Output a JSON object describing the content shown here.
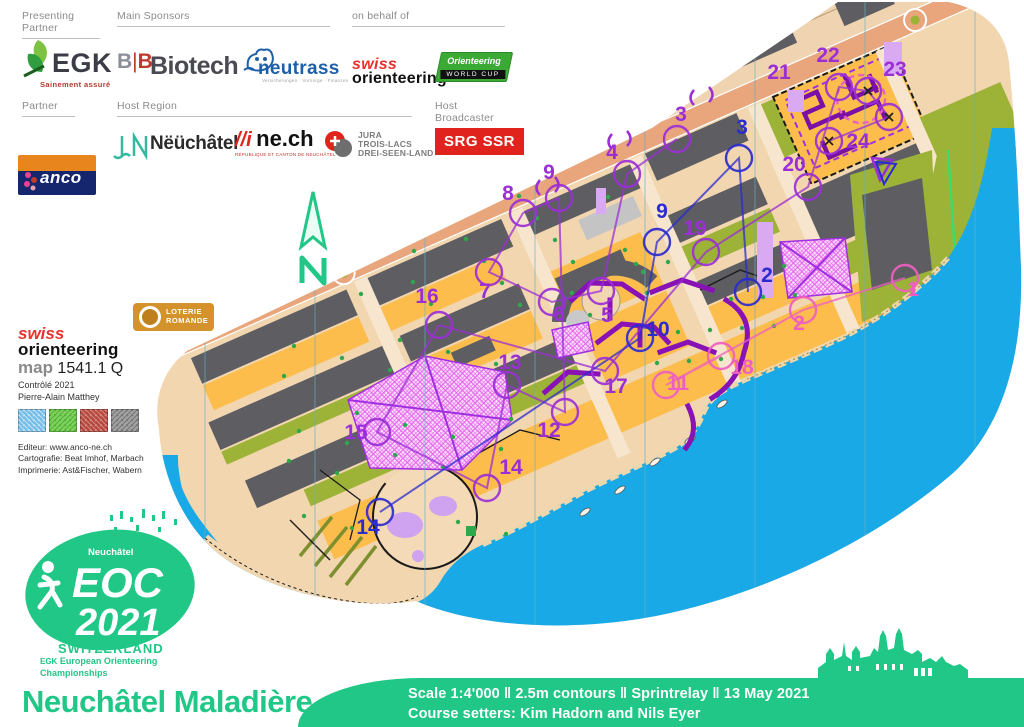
{
  "header": {
    "presenting_partner_label": "Presenting Partner",
    "main_sponsors_label": "Main Sponsors",
    "on_behalf_label": "on behalf of",
    "partner_label": "Partner",
    "host_region_label": "Host Region",
    "host_broadcaster_label": "Host Broadcaster",
    "egk": {
      "name": "EGK",
      "tagline": "Sainement assuré"
    },
    "bb_biotech": {
      "b1": "B",
      "bar": "|",
      "b2": "B",
      "word": "Biotech"
    },
    "neutrass": {
      "name": "neutrass",
      "tagline": "Versicherungen · Vorsorge · Finanzen"
    },
    "swiss_orienteering": {
      "line1": "swiss",
      "line2": "orienteering"
    },
    "world_cup": {
      "line1": "Orienteering",
      "line2": "WORLD CUP"
    },
    "banco": {
      "name": "anco"
    },
    "ville_neuchatel": {
      "name": "Nëüchâtel"
    },
    "ne_ch": {
      "name": "ne.ch",
      "sub": "RÉPUBLIQUE ET CANTON DE NEUCHÂTEL"
    },
    "jura": {
      "l1": "JURA",
      "l2": "TROIS-LACS",
      "l3": "DREI-SEEN-LAND"
    },
    "srg": {
      "name": "SRG SSR"
    }
  },
  "map_info": {
    "brand1": "swiss",
    "brand2": "orienteering",
    "map_word": "map",
    "map_number": "1541.1 Q",
    "control_line": "Contrôlé 2021",
    "controller": "Pierre-Alain Matthey",
    "editor": "Editeur: www.anco-ne.ch",
    "cartography": "Cartografie: Beat Imhof, Marbach",
    "printer": "Imprimerie: Ast&Fischer, Wabern",
    "loterie_l1": "LOTERIE",
    "loterie_l2": "ROMANDE"
  },
  "compass": {
    "letter": "N"
  },
  "eoc_logo": {
    "city": "Neuchâtel",
    "line1": "EOC",
    "line2": "2021",
    "line3": "SWITZERLAND",
    "egk": "EGK",
    "line4": "European Orienteering",
    "line5": "Championships"
  },
  "footer": {
    "title": "Neuchâtel Maladière",
    "bar_line1": "Scale 1:4'000  ‖  2.5m contours  ‖  Sprintrelay  ‖  13 May 2021",
    "bar_line2": "Course setters: Kim Hadorn and Nils Eyer"
  },
  "course": {
    "colors": {
      "violet": "#9b2fd6",
      "blue": "#2b2bcf",
      "pink": "#ef5fc0"
    },
    "controls": [
      {
        "n": 3,
        "color": "violet",
        "cx": 677,
        "cy": 139,
        "tx": 681,
        "ty": 121
      },
      {
        "n": 4,
        "color": "violet",
        "cx": 627,
        "cy": 174,
        "tx": 612,
        "ty": 159
      },
      {
        "n": 5,
        "color": "violet",
        "cx": 601,
        "cy": 291,
        "tx": 607,
        "ty": 322
      },
      {
        "n": 6,
        "color": "violet",
        "cx": 552,
        "cy": 302,
        "tx": 559,
        "ty": 321
      },
      {
        "n": 7,
        "color": "violet",
        "cx": 489,
        "cy": 272,
        "tx": 485,
        "ty": 298
      },
      {
        "n": 8,
        "color": "violet",
        "cx": 523,
        "cy": 213,
        "tx": 508,
        "ty": 200
      },
      {
        "n": 9,
        "color": "violet",
        "cx": 559,
        "cy": 198,
        "tx": 549,
        "ty": 179
      },
      {
        "n": 12,
        "color": "violet",
        "cx": 565,
        "cy": 412,
        "tx": 549,
        "ty": 437
      },
      {
        "n": 13,
        "color": "violet",
        "cx": 507,
        "cy": 385,
        "tx": 510,
        "ty": 369
      },
      {
        "n": 14,
        "color": "violet",
        "cx": 487,
        "cy": 488,
        "tx": 511,
        "ty": 474
      },
      {
        "n": 15,
        "color": "violet",
        "cx": 377,
        "cy": 432,
        "tx": 356,
        "ty": 439
      },
      {
        "n": 16,
        "color": "violet",
        "cx": 439,
        "cy": 325,
        "tx": 427,
        "ty": 303
      },
      {
        "n": 17,
        "color": "violet",
        "cx": 605,
        "cy": 371,
        "tx": 616,
        "ty": 393
      },
      {
        "n": 19,
        "color": "violet",
        "cx": 706,
        "cy": 252,
        "tx": 695,
        "ty": 235
      },
      {
        "n": 20,
        "color": "violet",
        "cx": 808,
        "cy": 187,
        "tx": 794,
        "ty": 171
      },
      {
        "n": 21,
        "color": "violet",
        "cx": 839,
        "cy": 87,
        "tx": 779,
        "ty": 79
      },
      {
        "n": 22,
        "color": "violet",
        "cx": 868,
        "cy": 91,
        "tx": 828,
        "ty": 62,
        "xmark": true
      },
      {
        "n": 23,
        "color": "violet",
        "cx": 889,
        "cy": 117,
        "tx": 895,
        "ty": 76,
        "xmark": true
      },
      {
        "n": 24,
        "color": "violet",
        "cx": 829,
        "cy": 141,
        "tx": 858,
        "ty": 148,
        "xmark": true
      },
      {
        "n": 2,
        "color": "blue",
        "cx": 748,
        "cy": 292,
        "tx": 767,
        "ty": 282
      },
      {
        "n": 3,
        "color": "blue",
        "cx": 739,
        "cy": 158,
        "tx": 742,
        "ty": 134
      },
      {
        "n": 9,
        "color": "blue",
        "cx": 657,
        "cy": 242,
        "tx": 662,
        "ty": 218
      },
      {
        "n": 10,
        "color": "blue",
        "cx": 640,
        "cy": 338,
        "tx": 658,
        "ty": 336
      },
      {
        "n": 14,
        "color": "blue",
        "cx": 380,
        "cy": 512,
        "tx": 368,
        "ty": 534
      },
      {
        "n": 1,
        "color": "pink",
        "cx": 905,
        "cy": 278,
        "tx": 913,
        "ty": 296
      },
      {
        "n": 2,
        "color": "pink",
        "cx": 803,
        "cy": 310,
        "tx": 799,
        "ty": 330
      },
      {
        "n": 11,
        "color": "pink",
        "cx": 666,
        "cy": 385,
        "tx": 678,
        "ty": 390
      },
      {
        "n": 18,
        "color": "pink",
        "cx": 721,
        "cy": 356,
        "tx": 742,
        "ty": 374
      }
    ]
  }
}
